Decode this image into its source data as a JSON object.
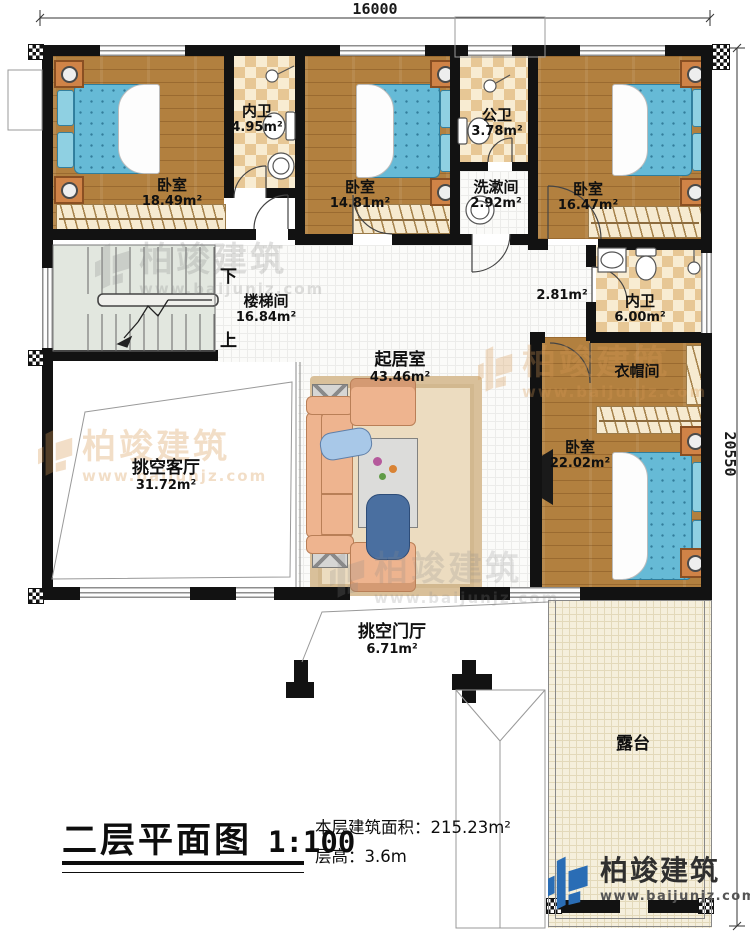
{
  "dimensions": {
    "top": "16000",
    "right": "20550"
  },
  "rooms": [
    {
      "id": "bedroom-tl",
      "label": "卧室",
      "area": "18.49m²"
    },
    {
      "id": "bath-tl",
      "label": "内卫",
      "area": "4.95m²"
    },
    {
      "id": "bedroom-tc",
      "label": "卧室",
      "area": "14.81m²"
    },
    {
      "id": "bath-public",
      "label": "公卫",
      "area": "3.78m²"
    },
    {
      "id": "washroom",
      "label": "洗漱间",
      "area": "2.92m²"
    },
    {
      "id": "bedroom-tr",
      "label": "卧室",
      "area": "16.47m²"
    },
    {
      "id": "stairwell",
      "label": "楼梯间",
      "area": "16.84m²"
    },
    {
      "id": "living",
      "label": "起居室",
      "area": "43.46m²"
    },
    {
      "id": "corridor",
      "label": "",
      "area": "2.81m²"
    },
    {
      "id": "bath-right",
      "label": "内卫",
      "area": "6.00m²"
    },
    {
      "id": "cloakroom",
      "label": "衣帽间",
      "area": ""
    },
    {
      "id": "bedroom-br",
      "label": "卧室",
      "area": "22.02m²"
    },
    {
      "id": "void-living",
      "label": "挑空客厅",
      "area": "31.72m²"
    },
    {
      "id": "void-foyer",
      "label": "挑空门厅",
      "area": "6.71m²"
    },
    {
      "id": "terrace",
      "label": "露台",
      "area": ""
    }
  ],
  "stairs": {
    "down": "下",
    "up": "上"
  },
  "title": {
    "name": "二层平面图",
    "scale": "1:100"
  },
  "info": {
    "area_label": "本层建筑面积：",
    "area_value": "215.23m²",
    "height_label": "层高：",
    "height_value": "3.6m"
  },
  "brand": {
    "name": "柏竣建筑",
    "url": "www.baijunjz.com"
  },
  "watermark": {
    "name": "柏竣建筑",
    "url": "www.baijunjz.com"
  },
  "colors": {
    "wall": "#121212",
    "wood_floor": "#b2803f",
    "tile": "#e7c795",
    "bed_blue": "#66bad6",
    "brand_blue": "#2a6db5",
    "watermark_orange": "#d99a55"
  }
}
